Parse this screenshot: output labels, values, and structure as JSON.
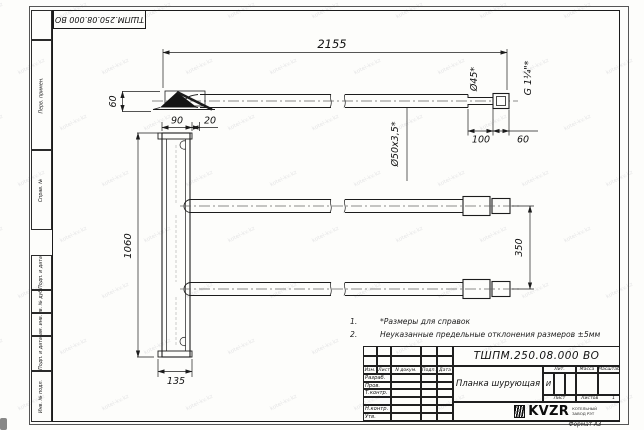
{
  "stamp_top": "ТШПМ.250.08.000 ВО",
  "watermark": {
    "text": "kotel-kv.kz"
  },
  "margin": {
    "labels": [
      "Перв. примен.",
      "Справ. №",
      "Подп. и дата",
      "Инв. № дубл.",
      "Взам. инв. №",
      "Подп. и дата",
      "Инв. № подл."
    ]
  },
  "dims": {
    "overall": "2155",
    "tip_offset": "60",
    "pipe_od": "Ø45*",
    "thread": "G 1¼\"*",
    "len100": "100",
    "len60": "60",
    "plate_top_90": "90",
    "plate_top_20": "20",
    "plate_height": "1060",
    "plate_foot": "135",
    "pipe_spec": "Ø50х3,5*",
    "spacing": "350"
  },
  "notes": [
    {
      "num": "1.",
      "text": "*Размеры для справок"
    },
    {
      "num": "2.",
      "text": "Неуказанные предельные отклонения размеров ±5мм"
    }
  ],
  "title_block": {
    "doc_number": "ТШПМ.250.08.000 ВО",
    "part_name": "Планка шурующая",
    "header_cells": [
      "Изм.",
      "Лист",
      "N докум.",
      "Подп.",
      "Дата"
    ],
    "row_labels": [
      "Разраб.",
      "Пров.",
      "Т.контр.",
      "",
      "Н.контр.",
      "Утв."
    ],
    "lit_header": "Лит.",
    "lit_value": "И",
    "mass_header": "Масса",
    "scale_header": "Масштаб",
    "sheet_label": "Лист",
    "sheets_label": "Листов",
    "sheets_value": "1",
    "company": {
      "name": "KVZR",
      "line1": "КОТЕЛЬНЫЙ",
      "line2": "ЗАВОД РЭТ"
    },
    "format_label": "Формат А3"
  }
}
